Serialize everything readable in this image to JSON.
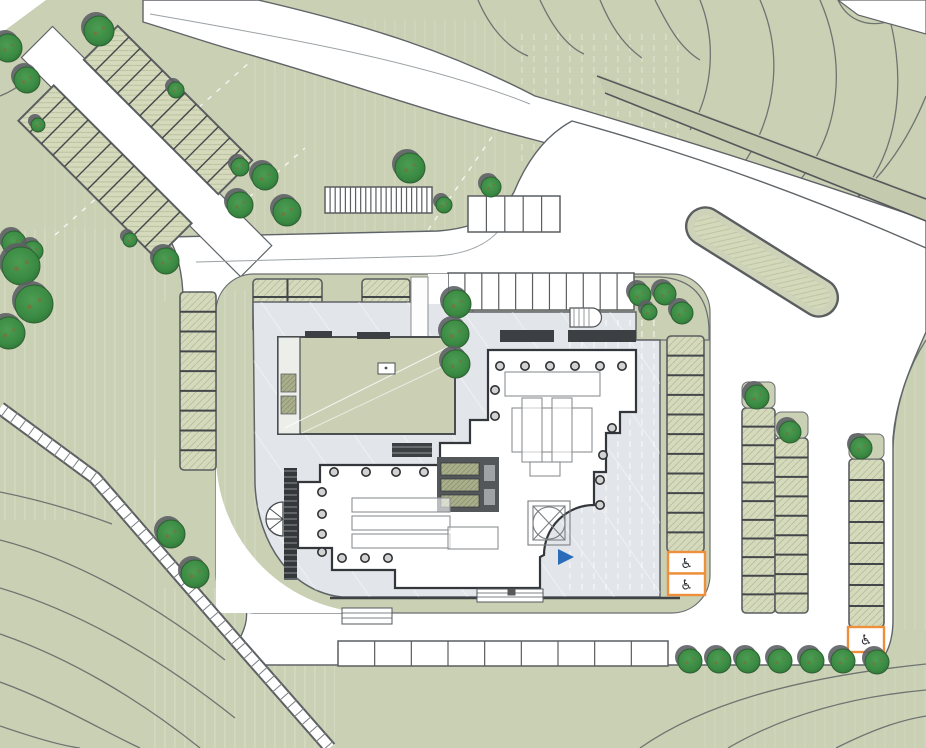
{
  "drawing": {
    "kind": "architectural-site-plan",
    "description": "site plan with central pavilion building, plaza, parking rows, roads and landscaped slopes"
  },
  "colors": {
    "lawn": "#cad0b4",
    "lawn_dark_edge": "#54585a",
    "road_white": "#ffffff",
    "road_edge": "#5f6468",
    "plaza": "#e2e5e9",
    "plaza_edge": "#5f6468",
    "parking_hatch": "#d6dabc",
    "parking_divider": "#43474a",
    "roof_green": "#cbd0b5",
    "wall_dark": "#33363a",
    "core_dark": "#53575a",
    "tree": "#3a8a43",
    "tree_shadow": "#5d6165",
    "accent_orange": "#ee8f3c",
    "accent_blue": "#2b6cb8",
    "contour": "#6e7470",
    "column_fill": "#d2d2d2"
  },
  "symbols": {
    "accessible": "♿"
  },
  "counts": {
    "trees": 38,
    "accessible_spaces": 3
  },
  "trees": [
    {
      "x": 99,
      "y": 31,
      "r": 15
    },
    {
      "x": 8,
      "y": 48,
      "r": 14
    },
    {
      "x": 27,
      "y": 80,
      "r": 13
    },
    {
      "x": 38,
      "y": 125,
      "r": 7
    },
    {
      "x": 176,
      "y": 90,
      "r": 8
    },
    {
      "x": 14,
      "y": 243,
      "r": 12
    },
    {
      "x": 33,
      "y": 251,
      "r": 10
    },
    {
      "x": 21,
      "y": 266,
      "r": 19
    },
    {
      "x": 34,
      "y": 304,
      "r": 19
    },
    {
      "x": 9,
      "y": 333,
      "r": 16
    },
    {
      "x": 240,
      "y": 167,
      "r": 9
    },
    {
      "x": 240,
      "y": 205,
      "r": 13
    },
    {
      "x": 265,
      "y": 177,
      "r": 13
    },
    {
      "x": 287,
      "y": 212,
      "r": 14
    },
    {
      "x": 410,
      "y": 168,
      "r": 15
    },
    {
      "x": 444,
      "y": 205,
      "r": 8
    },
    {
      "x": 491,
      "y": 187,
      "r": 10
    },
    {
      "x": 130,
      "y": 240,
      "r": 7
    },
    {
      "x": 166,
      "y": 261,
      "r": 13
    },
    {
      "x": 457,
      "y": 304,
      "r": 14
    },
    {
      "x": 455,
      "y": 334,
      "r": 14
    },
    {
      "x": 456,
      "y": 364,
      "r": 14
    },
    {
      "x": 640,
      "y": 295,
      "r": 11
    },
    {
      "x": 665,
      "y": 294,
      "r": 11
    },
    {
      "x": 649,
      "y": 312,
      "r": 8
    },
    {
      "x": 682,
      "y": 313,
      "r": 11
    },
    {
      "x": 757,
      "y": 397,
      "r": 12
    },
    {
      "x": 790,
      "y": 432,
      "r": 11
    },
    {
      "x": 861,
      "y": 448,
      "r": 11
    },
    {
      "x": 171,
      "y": 534,
      "r": 14
    },
    {
      "x": 195,
      "y": 574,
      "r": 14
    },
    {
      "x": 690,
      "y": 661,
      "r": 12
    },
    {
      "x": 719,
      "y": 661,
      "r": 12
    },
    {
      "x": 748,
      "y": 661,
      "r": 12
    },
    {
      "x": 780,
      "y": 661,
      "r": 12
    },
    {
      "x": 812,
      "y": 661,
      "r": 12
    },
    {
      "x": 843,
      "y": 661,
      "r": 12
    },
    {
      "x": 877,
      "y": 662,
      "r": 12
    }
  ],
  "parking": {
    "green_rows": [
      {
        "x": 180,
        "y": 292,
        "w": 36,
        "h": 178,
        "n": 9
      },
      {
        "x": 667,
        "y": 336,
        "w": 37,
        "h": 216,
        "n": 11
      },
      {
        "x": 742,
        "y": 408,
        "w": 33,
        "h": 205,
        "n": 11
      },
      {
        "x": 775,
        "y": 438,
        "w": 33,
        "h": 175,
        "n": 9
      },
      {
        "x": 849,
        "y": 459,
        "w": 35,
        "h": 168,
        "n": 8
      }
    ],
    "grids": [
      {
        "x": 253,
        "y": 279,
        "w": 69,
        "h": 54,
        "cols": 2,
        "rows": 3
      },
      {
        "x": 362,
        "y": 279,
        "w": 48,
        "h": 54,
        "cols": 1,
        "rows": 3
      }
    ],
    "white_rows": [
      {
        "x": 448,
        "y": 273,
        "w": 186,
        "h": 37,
        "n": 11
      },
      {
        "x": 468,
        "y": 196,
        "w": 92,
        "h": 36,
        "n": 5
      },
      {
        "x": 338,
        "y": 641,
        "w": 330,
        "h": 25,
        "n": 9
      },
      {
        "x": 325,
        "y": 187,
        "w": 107,
        "h": 26,
        "n": 21
      }
    ],
    "diagonal_strips": [
      {
        "cx": 168,
        "cy": 110,
        "len": 190,
        "wid": 48,
        "angle": 45,
        "n": 12
      },
      {
        "cx": 105,
        "cy": 172,
        "len": 195,
        "wid": 50,
        "angle": 45,
        "n": 12
      }
    ],
    "pockets": [
      {
        "x": 742,
        "y": 382,
        "w": 33,
        "h": 26
      },
      {
        "x": 775,
        "y": 412,
        "w": 33,
        "h": 26
      },
      {
        "x": 849,
        "y": 434,
        "w": 35,
        "h": 25
      }
    ],
    "accessible": [
      {
        "x": 668,
        "y": 552,
        "w": 37,
        "h": 43,
        "cells": 2
      },
      {
        "x": 848,
        "y": 627,
        "w": 36,
        "h": 25,
        "cells": 1
      }
    ]
  },
  "building": {
    "columns": [
      [
        500,
        366
      ],
      [
        525,
        366
      ],
      [
        550,
        366
      ],
      [
        575,
        366
      ],
      [
        600,
        366
      ],
      [
        622,
        366
      ],
      [
        495,
        390
      ],
      [
        495,
        416
      ],
      [
        612,
        428
      ],
      [
        603,
        455
      ],
      [
        600,
        480
      ],
      [
        600,
        505
      ],
      [
        334,
        472
      ],
      [
        366,
        472
      ],
      [
        396,
        472
      ],
      [
        424,
        472
      ],
      [
        322,
        492
      ],
      [
        322,
        514
      ],
      [
        322,
        534
      ],
      [
        322,
        552
      ],
      [
        342,
        558
      ],
      [
        365,
        558
      ],
      [
        388,
        558
      ]
    ],
    "furniture": [
      [
        505,
        372,
        95,
        24
      ],
      [
        512,
        408,
        80,
        44
      ],
      [
        522,
        398,
        20,
        64
      ],
      [
        552,
        398,
        20,
        64
      ],
      [
        352,
        498,
        98,
        14
      ],
      [
        352,
        516,
        98,
        14
      ],
      [
        352,
        534,
        98,
        14
      ],
      [
        448,
        527,
        50,
        22
      ],
      [
        530,
        462,
        30,
        14
      ]
    ]
  },
  "entrance_arrow": {
    "points": "558,549 574,557 558,565"
  },
  "path_rungs": {
    "polyline": [
      [
        0,
        408
      ],
      [
        95,
        478
      ],
      [
        237,
        642
      ],
      [
        330,
        748
      ]
    ],
    "spacing": 11,
    "len": 13
  }
}
